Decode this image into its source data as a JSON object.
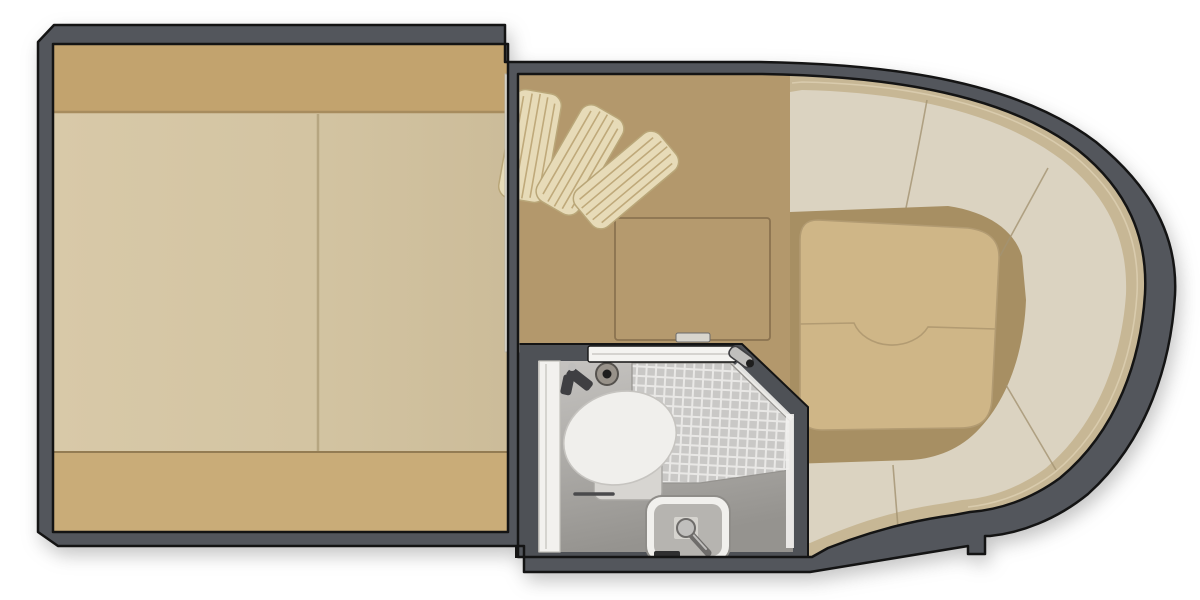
{
  "meta": {
    "title": "Boat cabin floor plan (top view)",
    "view": "overhead floor plan",
    "rooms": {
      "left": "forward berth cabin with mattress",
      "middle": "mid cabin with floor hatch and louvered folding doors",
      "bottom_middle": "head compartment with toilet, tiled shower and sink",
      "right": "U-shaped wraparound lounge seating at the bow"
    }
  },
  "colors": {
    "background": "#ffffff",
    "hull_wall": "#53565c",
    "outline": "#141414",
    "divider_white": "#ebe8e0",
    "divider_edge": "#b9b3a6",
    "bed_pillow": "#c2a36e",
    "bed_pillow_edge": "#a78c5e",
    "bed_mattress_light": "#d8c9a8",
    "bed_mattress_mid": "#d3c4a2",
    "bed_mattress_dark": "#ccbc99",
    "bed_foot": "#c9ac78",
    "bed_foot_edge": "#937c53",
    "bed_seam": "#b2a17c",
    "floor_tan": "#b3986c",
    "hatch_fill": "#b59a6e",
    "hatch_line": "#8b7350",
    "latch_fill": "#d8d5cd",
    "latch_edge": "#6b6b6b",
    "louver_fill": "#e7dbb8",
    "louver_edge": "#b9a678",
    "louver_line": "#bfa97a",
    "rim_tan": "#c7b795",
    "rim_highlight": "#dccfb2",
    "seat_cream": "#dbd3c1",
    "seat_seam": "#a49372",
    "bow_floor": "#a78f63",
    "cushion_fill": "#cfb687",
    "cushion_edge": "#b29b72",
    "bath_wall": "#4e5156",
    "bath_floor_light": "#c6c4c1",
    "bath_floor_dark": "#95938f",
    "tile_base": "#c9c8c6",
    "tile_grout": "#e9e8e6",
    "white_trim": "#f2f1ee",
    "white_trim_edge": "#c2c0bb",
    "door_track": "#f4f3f0",
    "chrome": "#c0bfbd",
    "chrome_dark": "#6e6c6a",
    "toilet_lid": "#f0efec",
    "toilet_lid_edge": "#c6c4c0",
    "toilet_base": "#d7d5d1",
    "toilet_base_edge": "#a9a7a3",
    "sink_rim": "#f1f0ed",
    "sink_rim_edge": "#8f8d89",
    "sink_basin": "#b6b4b0",
    "drain_plate": "#d9d7d3",
    "fitting_dark": "#3f3f42",
    "valve_body": "#98928a",
    "valve_edge": "#55524e",
    "valve_center": "#1e1e1e",
    "vent_dark": "#2f2f30",
    "towel_bar": "#4a4a4c"
  }
}
